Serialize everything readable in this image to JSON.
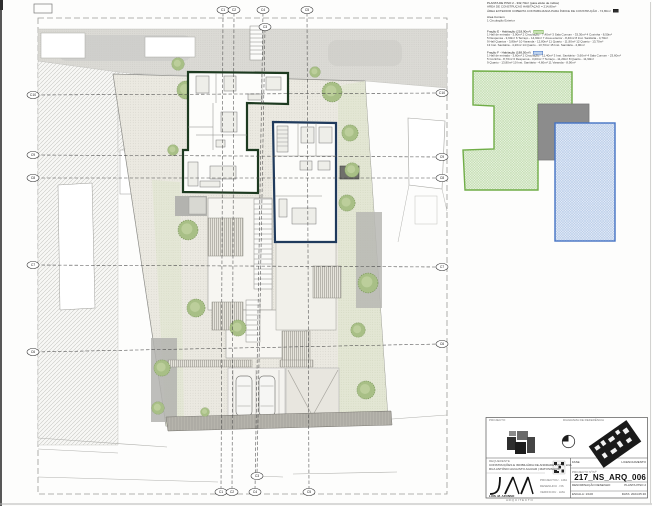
{
  "info_block": {
    "lines": [
      "PLANTA DE PISO 2 - 332,70m² (para efeito de índice)",
      "ÁREA DE CONSTRUÇÃO HABITAÇÃO = 214,80m²",
      "ÁREA EXTERIOR COBERTA CONTABILIZADA PARA ÍNDICE DE CONSTRUÇÃO - 74,80m²",
      "Área Comum",
      "1 Circulação Exterior",
      "Fração E - Habitação (218,90m²)",
      "1 Hall de entrada - 3,90m²   2 Circulação - 7,40m²   3 Sala Comum - 33,30m²   4 Cozinha - 8,50m²",
      "5 Despensa - 3,90m²   6 Terraço - 14,90m²   7 Área exterior - 8,40m²   8 Inst. Sanitária - 4,70m²",
      "9 Hall Quartos - 3,80m²   10 Varanda - 12,80m²   11 Quarto - 11,90m²   12 Quarto - 13,70m²",
      "13 Inst. Sanitária - 4,20m²   14 Quarto - 13,70m²   15 Inst. Sanitária - 4,90m²",
      "Fração F - Habitação (188,50m²)",
      "1 Hall de entrada - 3,60m²   2 Circulação - 11,40m²   3 Inst. Sanitária - 3,60m²   4 Sala Comum - 23,60m²",
      "5 Cozinha - 8,70m²   6 Despensa - 3,00m²   7 Terraço - 11,20m²   8 Quarto - 11,90m²",
      "9 Quarto - 13,80m²   10 Inst. Sanitária - 4,60m²   11 Varanda - 8,90m²"
    ]
  },
  "grid": {
    "c1": "C1",
    "c2": "C2",
    "c3": "C3",
    "c4": "C4",
    "c5": "C5",
    "c6": "C6",
    "c7": "C7",
    "c8": "C8",
    "c9": "C9",
    "c10": "C10"
  },
  "legend": {
    "green_area_color": "#70ad47",
    "gray_area_color": "#8c8c8c",
    "blue_area_color": "#4472c4"
  },
  "colors": {
    "wall_green": "#1d3a20",
    "wall_blue": "#1f3a5c",
    "tree_green": "#a8bf86"
  },
  "title_block": {
    "projecto_label": "PROJECTO",
    "diagrama_label": "DIAGRAMA DE REFERÊNCIA",
    "requerente_label": "REQUERENTE",
    "requerente_line1": "CONSTRUÇÕES E IMOBILIÁRIA DE ANDRADE PINTO, LDA",
    "requerente_line2": "RUA ANTÓNIO AUGUSTO AGUIAR | MATOSINHOS",
    "coord_rows": [
      "PROJECTOU . LMA",
      "DESENHOU . NS",
      "VERIFICOU . LMA"
    ],
    "logo_text": "LUIS .M. AFONSO",
    "logo_sub": "A R Q U I T E C T O",
    "fase_label": "FASE",
    "fase_value": "LICENCIAMENTO",
    "proj_label": "PROJECTO Nº/Nª",
    "proj_value": "217_NS_ARQ_006",
    "denom_label": "DENOMINAÇÃO DESENHO",
    "denom_value": "PLANTA PISO 2",
    "escala_label": "ESCALA:",
    "escala_value": "1/100",
    "data_label": "DATA:",
    "data_value": "2024.05.30"
  }
}
